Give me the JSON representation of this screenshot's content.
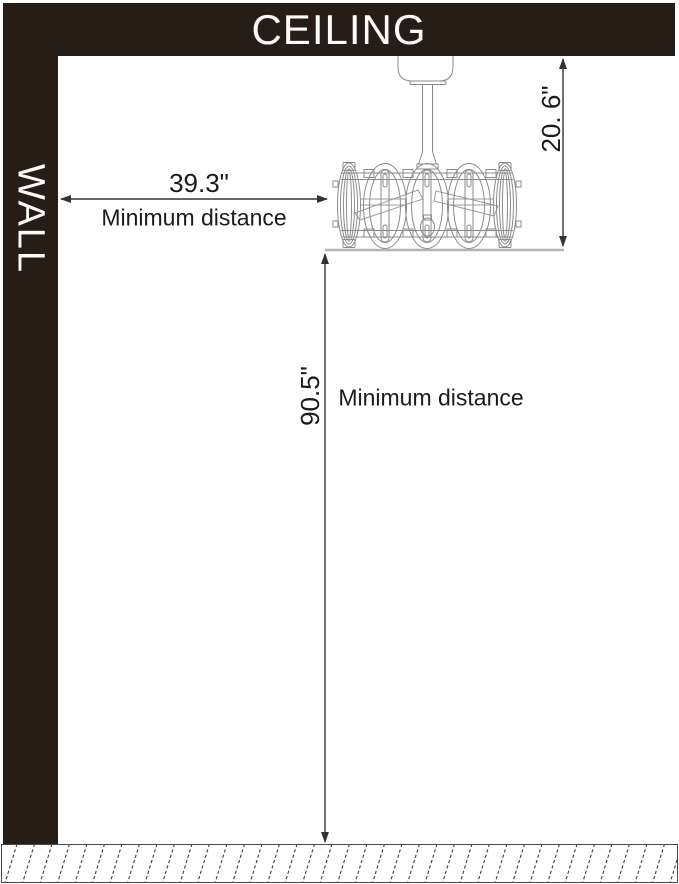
{
  "labels": {
    "ceiling": "CEILING",
    "wall": "WALL"
  },
  "dims": {
    "drop": {
      "value": "20. 6\""
    },
    "wall": {
      "value": "39.3\"",
      "label": "Minimum distance"
    },
    "floor": {
      "value": "90.5\"",
      "label": "Minimum distance"
    }
  },
  "fixture": {
    "name": "caged-ceiling-fan-with-downrod"
  },
  "colors": {
    "structure": "#271d17",
    "structure_text": "#fdfbf7",
    "dimension_line": "#333333",
    "label_text": "#1b1b1b",
    "fixture_line": "#8b8b8b",
    "fixture_baseline": "#b4b4b4",
    "floor_hatch": "#3c3c3c"
  }
}
